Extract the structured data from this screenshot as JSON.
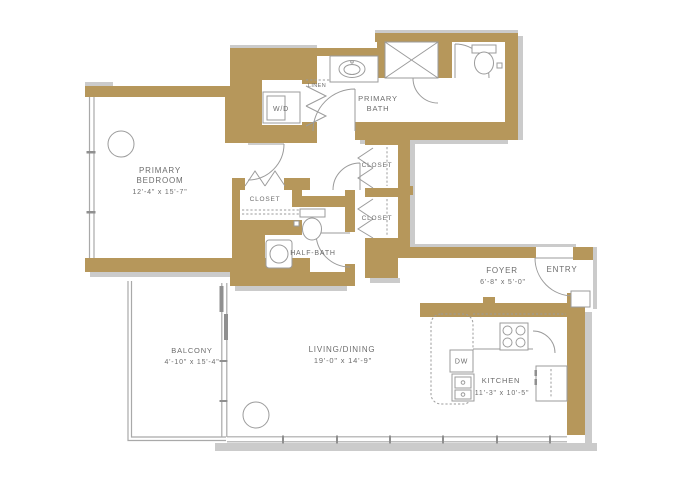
{
  "meta": {
    "type": "apartment-floor-plan"
  },
  "colors": {
    "wall": "#b6975b",
    "wall_shadow": "#cbcbcb",
    "line": "#9b9b9b",
    "window": "#a9a9a9",
    "door_panel": "#8f8f8f",
    "text": "#6d6d6d",
    "background": "#ffffff"
  },
  "rooms": {
    "primary_bedroom": {
      "name_line1": "PRIMARY",
      "name_line2": "BEDROOM",
      "dims": "12'-4\" x 15'-7\""
    },
    "primary_bath": {
      "name_line1": "PRIMARY",
      "name_line2": "BATH"
    },
    "wd_closet": {
      "name": "W/D"
    },
    "linen": {
      "name": "LINEN"
    },
    "bedroom_closet": {
      "name": "CLOSET"
    },
    "hall_closet_upper": {
      "name": "CLOSET"
    },
    "hall_closet_lower": {
      "name": "CLOSET"
    },
    "half_bath": {
      "name": "HALF-BATH"
    },
    "foyer": {
      "name": "FOYER",
      "dims": "6'-8\" x 5'-0\""
    },
    "entry": {
      "name": "ENTRY"
    },
    "kitchen": {
      "name": "KITCHEN",
      "dims": "11'-3\" x 10'-5\""
    },
    "living_dining": {
      "name": "LIVING/DINING",
      "dims": "19'-0\" x 14'-9\""
    },
    "balcony": {
      "name": "BALCONY",
      "dims": "4'-10\" x 15'-4\""
    }
  },
  "appliances": {
    "dishwasher": "DW"
  }
}
